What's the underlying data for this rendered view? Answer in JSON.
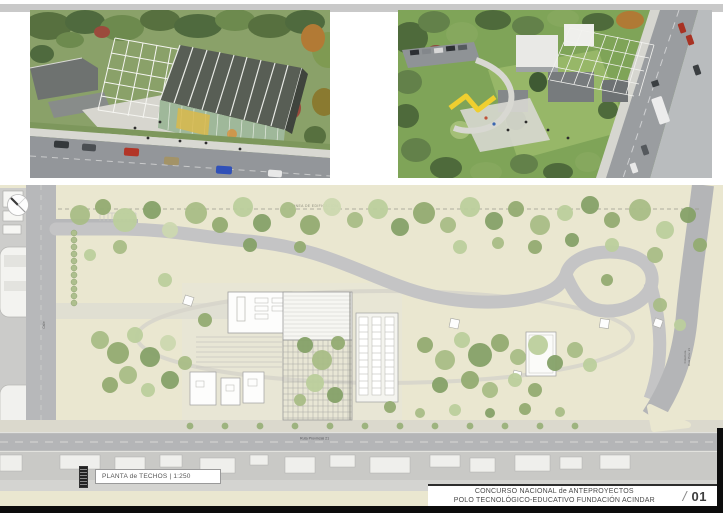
{
  "document": {
    "plan_title_bar": {
      "label": "PLANTA de TECHOS | 1:250"
    },
    "title_block": {
      "line1": "CONCURSO NACIONAL de ANTEPROYECTOS",
      "line2": "POLO TECNOLÓGICO-EDUCATIVO FUNDACIÓN ACINDAR",
      "divider": "/",
      "sheet_number": "01"
    },
    "plan_annotations": {
      "bottom_road": "Ruta Provincial 21",
      "left_street": "Calle",
      "right_street_line1": "Colectora",
      "right_street_line2": "Ruta Prov. 21",
      "setback_line": "LINEA DE EDIFICACION"
    },
    "colors": {
      "site_ground": "#eae7d0",
      "road_grey": "#b4b5b7",
      "vegetation_green": "#9cb47c",
      "canopy_yellow": "#efcf2f",
      "frame_black": "#0c0c0c"
    }
  }
}
